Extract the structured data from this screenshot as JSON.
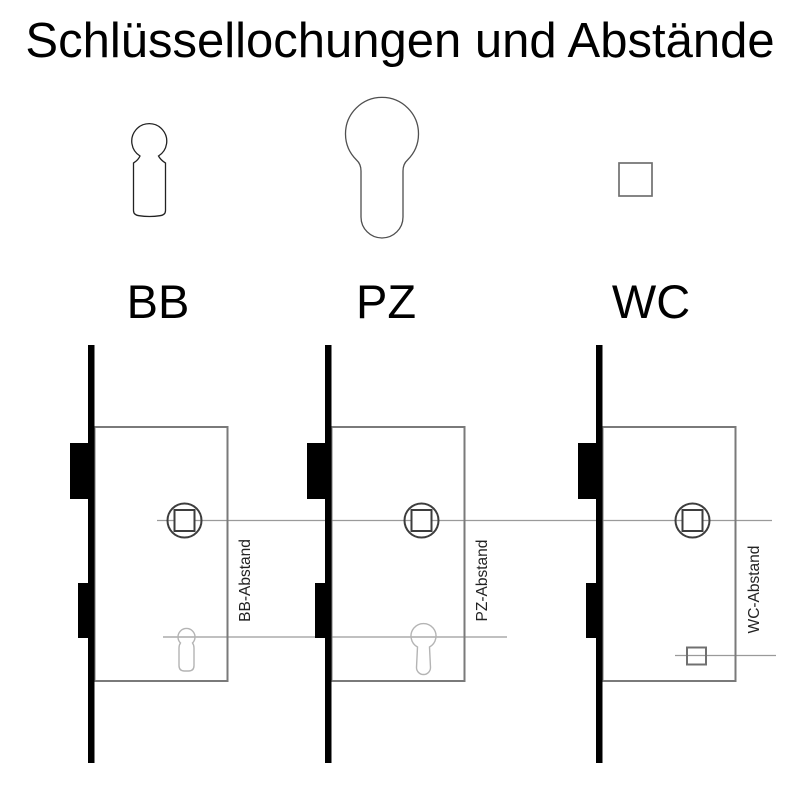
{
  "title": "Schlüssellochungen und Abstände",
  "keyhole_types": [
    {
      "id": "bb",
      "label": "BB",
      "shape": "bit-key-keyhole"
    },
    {
      "id": "pz",
      "label": "PZ",
      "shape": "profile-cylinder"
    },
    {
      "id": "wc",
      "label": "WC",
      "shape": "square-spindle"
    }
  ],
  "locks": [
    {
      "id": "bb",
      "distance_label": "BB-Abstand"
    },
    {
      "id": "pz",
      "distance_label": "PZ-Abstand"
    },
    {
      "id": "wc",
      "distance_label": "WC-Abstand"
    }
  ],
  "colors": {
    "background": "#ffffff",
    "ink_black": "#000000",
    "case_outline": "#7a7a7a",
    "follower_outline": "#3d3d3d",
    "dimension_line": "#9a9a9a",
    "inner_keyhole_gray": "#b4b4b4",
    "pz_outline": "#4f4f4f",
    "wc_outline": "#707070"
  }
}
